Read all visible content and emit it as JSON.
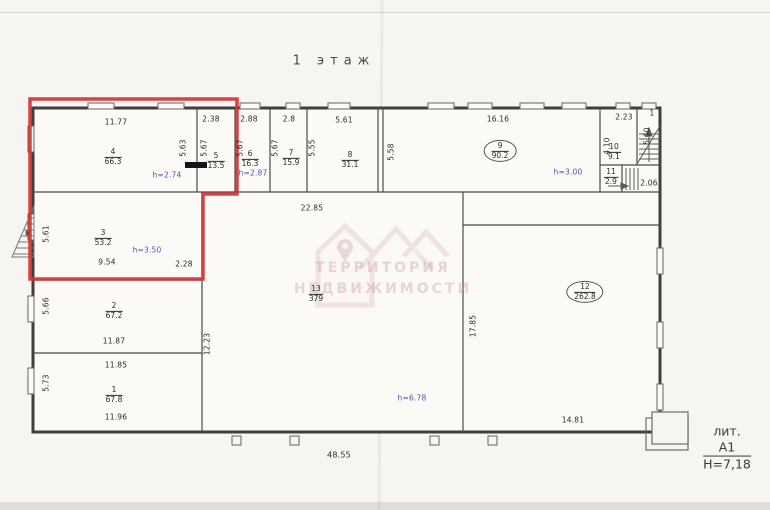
{
  "title": "1  этаж",
  "rooms": [
    {
      "num": "1",
      "area": "67.8"
    },
    {
      "num": "2",
      "area": "67.2"
    },
    {
      "num": "3",
      "area": "53.2"
    },
    {
      "num": "4",
      "area": "66.3"
    },
    {
      "num": "5",
      "area": "13.5"
    },
    {
      "num": "6",
      "area": "16.3"
    },
    {
      "num": "7",
      "area": "15.9"
    },
    {
      "num": "8",
      "area": "31.1"
    },
    {
      "num": "9",
      "area": "90.2"
    },
    {
      "num": "10",
      "area": "9.1"
    },
    {
      "num": "11",
      "area": "2.9"
    },
    {
      "num": "12",
      "area": "262.8"
    },
    {
      "num": "13",
      "area": "379"
    }
  ],
  "dims": {
    "room4_w": "11.77",
    "room5_w": "2.38",
    "room6_w": "2.88",
    "room7_w": "2.8",
    "room8_w": "5.61",
    "room9_w": "16.16",
    "room10_w": "2.23",
    "stair_flight": "1",
    "room11_adj": "2.06",
    "room4_h": "5.63",
    "room5_h": "5.67",
    "room6_h": "5.67",
    "room7_h": "5.67",
    "room8_h": "5.55",
    "wall_h": "5.58",
    "room10_h": "4.10",
    "stairs_h": "5.60",
    "room3_h": "5.61",
    "room3_w": "9.54",
    "room3_adj": "2.28",
    "hall_w": "22.85",
    "room2_h": "5.66",
    "room2_w": "11.87",
    "room1_wt": "11.85",
    "room1_h": "5.73",
    "room1_w": "11.96",
    "left_total": "12.23",
    "room12_h": "17.85",
    "room12_w": "14.81",
    "overall_w": "48.55"
  },
  "heights": {
    "room4": "h=2.74",
    "room6": "h=2.87",
    "room9": "h=3.00",
    "room3": "h=3.50",
    "hall13": "h=6.78"
  },
  "footer": {
    "lit": "лит. А1",
    "building_height": "Н=7,18"
  },
  "watermark": {
    "line1": "ТЕРРИТОРИЯ",
    "line2": "НЕДВИЖИМОСТИ"
  },
  "colors": {
    "highlight_red": "#d23333",
    "height_label_blue": "#5353ae"
  }
}
